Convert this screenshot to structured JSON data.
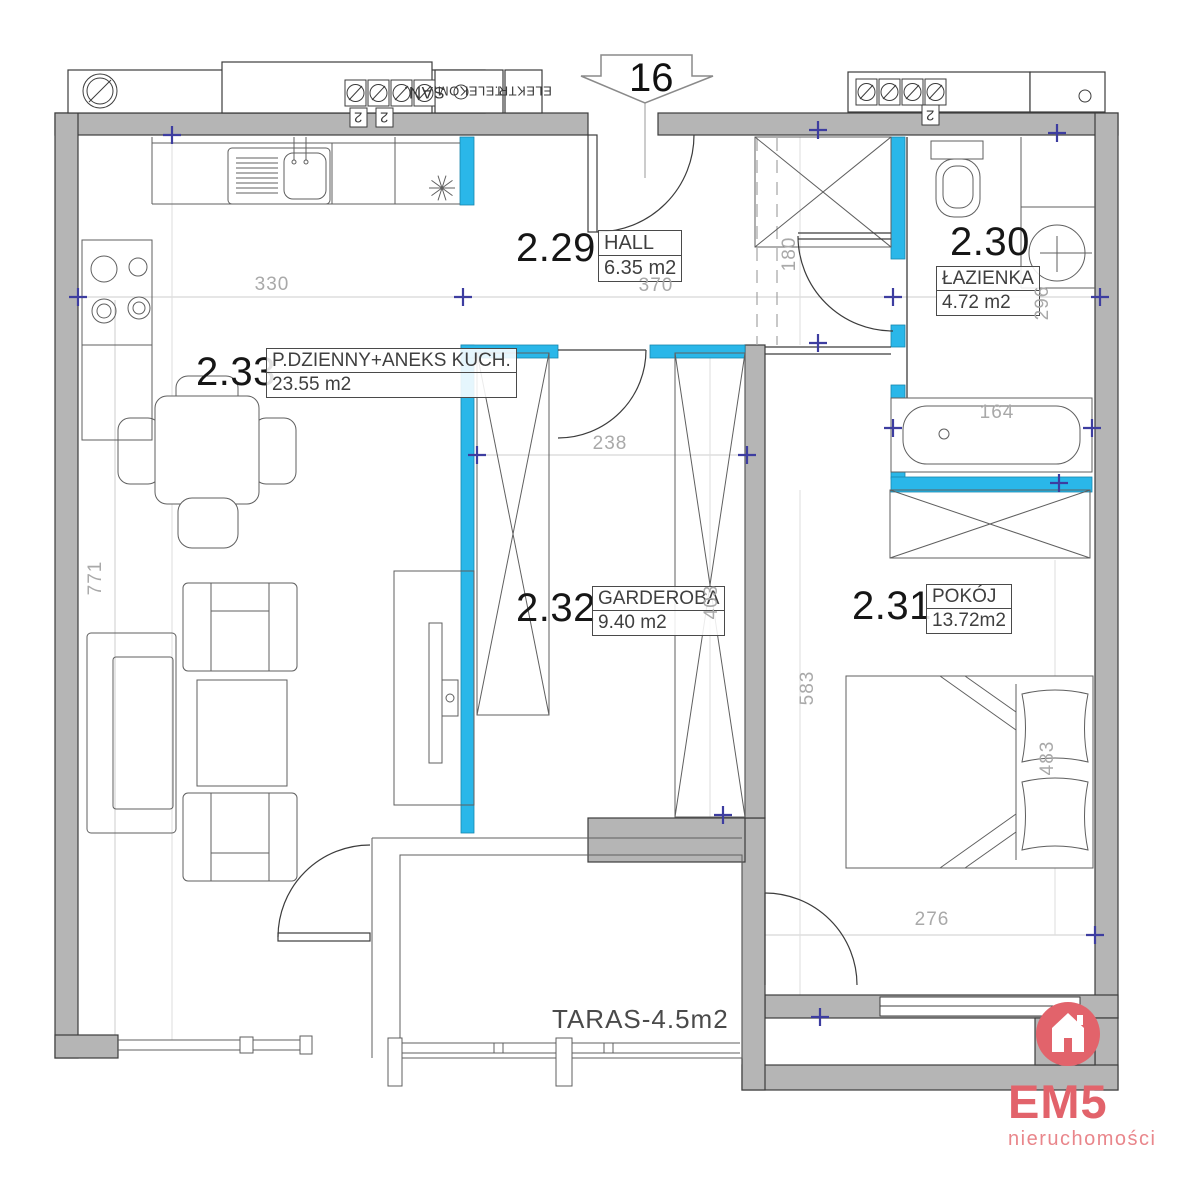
{
  "plan": {
    "apartment_number": "16",
    "rooms": [
      {
        "number": "2.29",
        "name": "HALL",
        "area": "6.35 m2"
      },
      {
        "number": "2.30",
        "name": "ŁAZIENKA",
        "area": "4.72 m2"
      },
      {
        "number": "2.31",
        "name": "POKÓJ",
        "area": "13.72m2"
      },
      {
        "number": "2.32",
        "name": "GARDEROBA",
        "area": "9.40 m2"
      },
      {
        "number": "2.33",
        "name": "P.DZIENNY+ANEKS KUCH.",
        "area": "23.55 m2"
      }
    ],
    "terrace_label": "TARAS-4.5m2",
    "dimensions": {
      "kitchen_wall": "330",
      "hall_width": "370",
      "hall_door": "180",
      "bathroom_depth": "296",
      "garderoba_width": "238",
      "garderoba_depth": "403",
      "living_depth": "771",
      "bedroom_depth": "583",
      "bedroom_wall": "483",
      "bedroom_width": "276",
      "bathtub_width": "164"
    },
    "risers": {
      "san": "SAN.",
      "telekom": "TELEKOM.",
      "elektr": "ELEKTR.",
      "meter_a": "2",
      "meter_b": "2",
      "meter_c": "2"
    }
  },
  "branding": {
    "name": "EM5",
    "tagline": "nieruchomości"
  },
  "colors": {
    "wall_fill": "#b5b5b5",
    "highlight_wall": "#2ab7e9",
    "reference_marker": "#3d3da0",
    "brand_red": "#e2636b",
    "dimension_text": "#a9a9a9"
  }
}
